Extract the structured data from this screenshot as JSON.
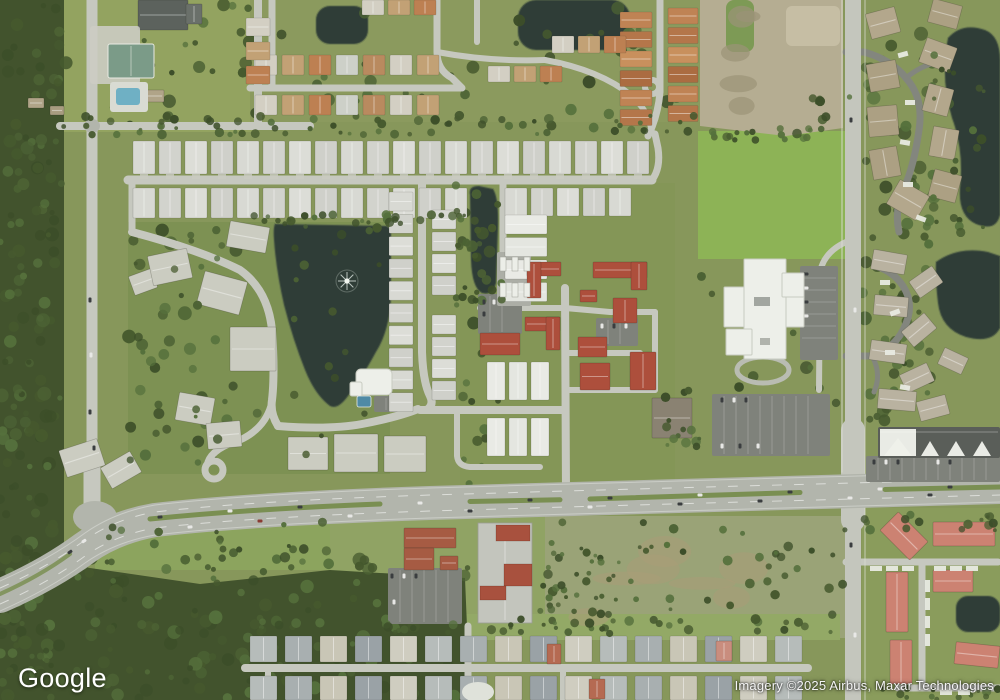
{
  "branding": {
    "logo_text": "Google"
  },
  "attribution": {
    "text": "Imagery ©2025 Airbus, Maxar Technologies"
  },
  "map": {
    "view_type": "satellite-aerial",
    "visible_features": [
      "suburban residential neighborhoods",
      "row of identical single-family homes",
      "retention lake with fountain",
      "retention ponds",
      "condominium complexes",
      "red-roof condo cluster",
      "church campus with cross-shaped white building and parking lots",
      "divided highway with grass median",
      "strip mall with parking",
      "self-storage building",
      "cleared dirt lot",
      "wooded conservation areas",
      "apartment complex with salmon roofs",
      "tennis courts and pool",
      "lake fountain"
    ]
  },
  "palette": {
    "grass": "#87975b",
    "grass_bright": "#8db356",
    "forest": "#42532d",
    "tree_dark": "#3c4e29",
    "tree_mid": "#4c6234",
    "scrub": "#9aa377",
    "dirt": "#b5ad92",
    "road": "#c6c8bf",
    "road_dark": "#83867e",
    "highway": "#b2b5ac",
    "median": "#7a8f52",
    "parking": "#7f827b",
    "water": "#2f3d37",
    "roof_gray": "#d8d9d3",
    "roof_white": "#e9eae5",
    "roof_condo": "#cbccc1",
    "roof_tan": "#b3a78c",
    "roof_red": "#ad4f3c",
    "roof_salmon": "#cc8272",
    "roof_orange": "#bf8354",
    "roof_dark": "#5c625d",
    "building_white": "#edefe9",
    "pool": "#6fb0c4",
    "car_dark": "#3a3d3f",
    "car_white": "#e8e8e6"
  }
}
